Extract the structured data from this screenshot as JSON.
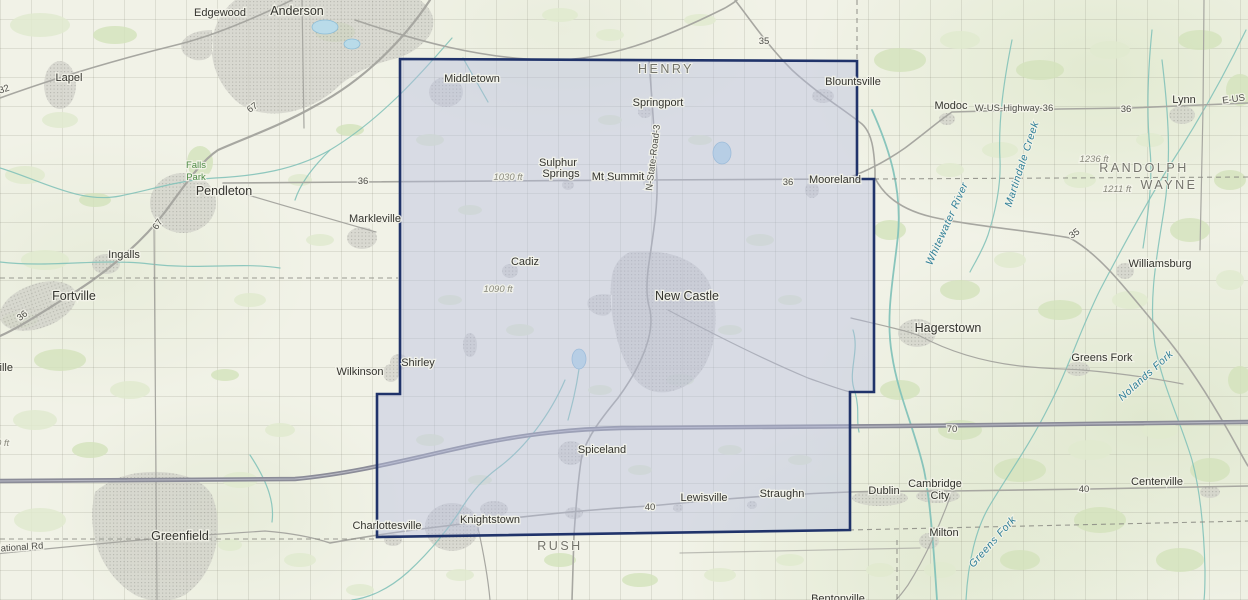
{
  "map": {
    "description": "Topographic reference map with a highlighted county boundary (Henry County area, Indiana)",
    "colors": {
      "county_fill": "#b6bcdf",
      "county_border": "#20336a",
      "county_label": "#74746c",
      "road": "#a7a7a1",
      "interstate": "#8b8c98",
      "interstate_core": "#c6c7d2",
      "water": "#83c2b9",
      "water_label": "#2e7e97",
      "lake_fill": "#b9dbe9",
      "lake_edge": "#8cbcd6",
      "urban": "#cfcfc8",
      "urban_dot": "#a3a39c",
      "veg_light": "#e1eacf",
      "veg_med": "#d3e2bb"
    },
    "labels": {
      "counties": [
        {
          "text": "HENRY",
          "x": 666,
          "y": 73
        },
        {
          "text": "RUSH",
          "x": 560,
          "y": 550
        },
        {
          "text": "RANDOLPH",
          "x": 1144,
          "y": 172
        },
        {
          "text": "WAYNE",
          "x": 1169,
          "y": 189
        }
      ],
      "towns": [
        {
          "text": "Edgewood",
          "x": 220,
          "y": 16
        },
        {
          "text": "Anderson",
          "x": 297,
          "y": 15,
          "big": true
        },
        {
          "text": "Lapel",
          "x": 69,
          "y": 81
        },
        {
          "text": "Pendleton",
          "x": 224,
          "y": 195,
          "big": true
        },
        {
          "text": "Ingalls",
          "x": 124,
          "y": 258
        },
        {
          "text": "Fortville",
          "x": 74,
          "y": 300,
          "big": true
        },
        {
          "text": "Markleville",
          "x": 375,
          "y": 222
        },
        {
          "text": "Middletown",
          "x": 472,
          "y": 82
        },
        {
          "text": "Springport",
          "x": 658,
          "y": 106
        },
        {
          "text": "Sulphur",
          "x": 558,
          "y": 166
        },
        {
          "text": "Springs",
          "x": 561,
          "y": 177
        },
        {
          "text": "Mt Summit",
          "x": 618,
          "y": 180
        },
        {
          "text": "Blountsville",
          "x": 853,
          "y": 85
        },
        {
          "text": "Mooreland",
          "x": 835,
          "y": 183
        },
        {
          "text": "New Castle",
          "x": 687,
          "y": 300,
          "big": true
        },
        {
          "text": "Cadiz",
          "x": 525,
          "y": 265
        },
        {
          "text": "Shirley",
          "x": 418,
          "y": 366
        },
        {
          "text": "Wilkinson",
          "x": 360,
          "y": 375
        },
        {
          "text": "Spiceland",
          "x": 602,
          "y": 453
        },
        {
          "text": "Knightstown",
          "x": 490,
          "y": 523
        },
        {
          "text": "Charlottesville",
          "x": 387,
          "y": 529
        },
        {
          "text": "Greenfield",
          "x": 180,
          "y": 540,
          "big": true
        },
        {
          "text": "Lewisville",
          "x": 704,
          "y": 501
        },
        {
          "text": "Straughn",
          "x": 782,
          "y": 497
        },
        {
          "text": "Dublin",
          "x": 884,
          "y": 494
        },
        {
          "text": "Cambridge",
          "x": 935,
          "y": 487
        },
        {
          "text": "City",
          "x": 940,
          "y": 499
        },
        {
          "text": "Milton",
          "x": 944,
          "y": 536
        },
        {
          "text": "Hagerstown",
          "x": 948,
          "y": 332,
          "big": true
        },
        {
          "text": "Greens Fork",
          "x": 1102,
          "y": 361
        },
        {
          "text": "Williamsburg",
          "x": 1160,
          "y": 267
        },
        {
          "text": "Modoc",
          "x": 951,
          "y": 109
        },
        {
          "text": "Lynn",
          "x": 1184,
          "y": 103
        },
        {
          "text": "Centerville",
          "x": 1157,
          "y": 485
        },
        {
          "text": "Bentonville",
          "x": 838,
          "y": 602
        },
        {
          "text": "ville",
          "x": -6,
          "y": 371,
          "anchor": "start"
        }
      ],
      "roads": [
        {
          "text": "35",
          "x": 764,
          "y": 44
        },
        {
          "text": "67",
          "x": 254,
          "y": 110,
          "rotate": -35
        },
        {
          "text": "67",
          "x": 160,
          "y": 226,
          "rotate": -55
        },
        {
          "text": "32",
          "x": 5,
          "y": 92,
          "rotate": -20
        },
        {
          "text": "36",
          "x": 363,
          "y": 184
        },
        {
          "text": "36",
          "x": 788,
          "y": 185
        },
        {
          "text": "36",
          "x": 24,
          "y": 318,
          "rotate": -38
        },
        {
          "text": "N-State-Road-3",
          "x": 656,
          "y": 158,
          "rotate": -83
        },
        {
          "text": "35",
          "x": 1076,
          "y": 236,
          "rotate": -35
        },
        {
          "text": "W-US-Highway-36",
          "x": 1014,
          "y": 111
        },
        {
          "text": "36",
          "x": 1126,
          "y": 112
        },
        {
          "text": "E-US",
          "x": 1234,
          "y": 102,
          "rotate": -8
        },
        {
          "text": "70",
          "x": 952,
          "y": 432
        },
        {
          "text": "40",
          "x": 650,
          "y": 510
        },
        {
          "text": "40",
          "x": 1084,
          "y": 492
        },
        {
          "text": "National Rd",
          "x": -6,
          "y": 552,
          "rotate": -4,
          "anchor": "start"
        }
      ],
      "waters": [
        {
          "text": "Whitewater River",
          "x": 950,
          "y": 225,
          "rotate": -66
        },
        {
          "text": "Martindale Creek",
          "x": 1025,
          "y": 165,
          "rotate": -72
        },
        {
          "text": "Nolands Fork",
          "x": 1148,
          "y": 378,
          "rotate": -42
        },
        {
          "text": "Greens Fork",
          "x": 995,
          "y": 544,
          "rotate": -48
        }
      ],
      "elevations": [
        {
          "text": "1030 ft",
          "x": 508,
          "y": 180
        },
        {
          "text": "1090 ft",
          "x": 498,
          "y": 292
        },
        {
          "text": "1236 ft",
          "x": 1094,
          "y": 162
        },
        {
          "text": "1211 ft",
          "x": 1117,
          "y": 192
        },
        {
          "text": "0 ft",
          "x": -4,
          "y": 446,
          "anchor": "start"
        }
      ],
      "parks": [
        {
          "text": "Falls",
          "x": 196,
          "y": 168
        },
        {
          "text": "Park",
          "x": 196,
          "y": 180
        }
      ]
    },
    "highlight": {
      "name": "Henry County",
      "points": "400,59 857,61 857,179 874,179 874,392 850,392 850,530 377,537 377,394 400,394"
    }
  }
}
